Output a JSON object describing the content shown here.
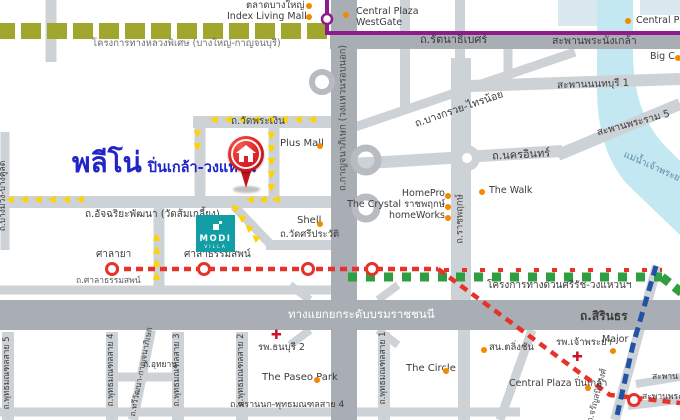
{
  "meta": {
    "width": 680,
    "height": 420,
    "description_visible": false
  },
  "brand": {
    "name": "พลีโน่",
    "subtitle": "ปิ่นเกล้า-วงแหวน"
  },
  "modi": {
    "line1": "MODI",
    "line2": "VILLA"
  },
  "icons": {
    "route-arrow": "◀",
    "hospital-cross": "✚",
    "poi-dot": "orange-circle",
    "station": "red-ring-circle"
  },
  "colors": {
    "brand_blue": "#2125c8",
    "pin_red": "#dc2026",
    "modi_teal": "#119fa5",
    "purple_line": "#8e1b8b",
    "red_line": "#e8312a",
    "green_line": "#2f9e41",
    "blue_line": "#2053a4",
    "route_arrow_yellow": "#ffd200",
    "motorway_olive": "#a1a72c",
    "poi_orange": "#f28a00",
    "river_blue": "#c3e8f2",
    "road_minor": "#cdd2d6",
    "road_major": "#a9aeb4"
  },
  "map": {
    "labels": [
      {
        "id": "talat-bang-yai-label",
        "text": "ตลาดบางใหญ่",
        "x": 246,
        "y": 1,
        "size": 9.5
      },
      {
        "id": "index-living-mall-label",
        "text": "Index Living Mall",
        "x": 227,
        "y": 12,
        "size": 9.5
      },
      {
        "id": "motorway-project-label",
        "text": "โครงการทางหลวงพิเศษ (บางใหญ่-กาญจนบุรี)",
        "x": 92,
        "y": 39,
        "size": 9.5,
        "color": "#6e6e6e"
      },
      {
        "id": "central-westgate-label",
        "text": "Central Plaza WestGate",
        "x": 356,
        "y": 7,
        "size": 9.5,
        "w": 66
      },
      {
        "id": "central-plaza-tr-label",
        "text": "Central Plaz",
        "x": 636,
        "y": 16,
        "size": 9.5
      },
      {
        "id": "rattanathibet-road-label",
        "text": "ถ.รัตนาธิเบศร์",
        "x": 420,
        "y": 34,
        "size": 11
      },
      {
        "id": "phranangklao-bridge-label",
        "text": "สะพานพระนั่งเกล้า",
        "x": 552,
        "y": 36,
        "size": 10.5
      },
      {
        "id": "big-c-label",
        "text": "Big C",
        "x": 650,
        "y": 52,
        "size": 9.5
      },
      {
        "id": "nonthaburi1-bridge-label",
        "text": "สะพานนนทบุรี 1",
        "x": 557,
        "y": 79,
        "size": 10,
        "rot": -2
      },
      {
        "id": "bang-kruai-sai-noi-road-label",
        "text": "ถ.บางกรวย-ไทรน้อย",
        "x": 413,
        "y": 104,
        "size": 10.5,
        "rot": -19
      },
      {
        "id": "rama5-bridge-label",
        "text": "สะพานพระราม 5",
        "x": 596,
        "y": 118,
        "size": 10,
        "rot": -15
      },
      {
        "id": "chao-phraya-river-label",
        "text": "แม่น้ำเจ้าพระยา",
        "x": 621,
        "y": 163,
        "size": 9.5,
        "rot": 24,
        "color": "#5b8ca6"
      },
      {
        "id": "nakhon-in-road-label",
        "text": "ถ.นครอินทร์",
        "x": 492,
        "y": 149,
        "size": 11,
        "rot": -3
      },
      {
        "id": "kanchanaphisek-road-label",
        "text": "ถ.กาญจนาภิเษก (วงแหวนรอบนอก)",
        "x": 344,
        "y": 118,
        "size": 9.5,
        "v": true,
        "color": "#4a4a4a"
      },
      {
        "id": "ratchaphruek-road-label",
        "text": "ถ.ราชพฤกษ์",
        "x": 461,
        "y": 219,
        "size": 9.5,
        "v": true,
        "color": "#4a4a4a"
      },
      {
        "id": "wat-phra-ngoen-road-label",
        "text": "ถ.วัดพระเงิน",
        "x": 231,
        "y": 116,
        "size": 10
      },
      {
        "id": "plus-mall-label",
        "text": "Plus Mall",
        "x": 280,
        "y": 138,
        "size": 10
      },
      {
        "id": "atchariya-road-label",
        "text": "ถ.อัจฉริยะพัฒนา (วัดส้มเกลี้ยง)",
        "x": 85,
        "y": 209,
        "size": 10
      },
      {
        "id": "shell-label",
        "text": "Shell",
        "x": 297,
        "y": 215,
        "size": 10
      },
      {
        "id": "wat-si-prawat-road-label",
        "text": "ถ.วัดศรีประวัติ",
        "x": 280,
        "y": 230,
        "size": 9.5
      },
      {
        "id": "homepro-label",
        "text": "HomePro",
        "x": 445,
        "y": 189,
        "size": 9.5,
        "align": "right"
      },
      {
        "id": "the-crystal-label",
        "text": "The Crystal ราชพฤกษ์",
        "x": 445,
        "y": 200,
        "size": 9.5,
        "align": "right"
      },
      {
        "id": "homeworks-label",
        "text": "homeWorks",
        "x": 445,
        "y": 211,
        "size": 9.5,
        "align": "right"
      },
      {
        "id": "the-walk-label",
        "text": "The Walk",
        "x": 489,
        "y": 186,
        "size": 9.5
      },
      {
        "id": "salaya-station-label",
        "text": "ศาลายา",
        "x": 96,
        "y": 249,
        "size": 10
      },
      {
        "id": "sala-thammasop-station-label",
        "text": "ศาลาธรรมสพน์",
        "x": 184,
        "y": 249,
        "size": 10
      },
      {
        "id": "sala-thammasop-road-label",
        "text": "ถ.ศาลาธรรมสพน์",
        "x": 76,
        "y": 277,
        "size": 8.5,
        "color": "#5a5a5a"
      },
      {
        "id": "si-rat-expressway-label",
        "text": "โครงการทางด่วนศรีรัช-วงแหวนฯ",
        "x": 487,
        "y": 280,
        "size": 10
      },
      {
        "id": "borom-interchange-label",
        "text": "ทางแยกยกระดับบรมราชชนนี",
        "x": 288,
        "y": 308,
        "size": 11.5,
        "color": "#ffffff"
      },
      {
        "id": "sirindhorn-road-label",
        "text": "ถ.สิรินธร",
        "x": 580,
        "y": 310,
        "size": 12,
        "bold": true
      },
      {
        "id": "charan-road-label",
        "text": "ถ.จรัญสนิทวงศ์",
        "x": 598,
        "y": 396,
        "size": 8.5,
        "rot": -75,
        "anchor": "center",
        "color": "#4a4a4a"
      },
      {
        "id": "talingchan-police-label",
        "text": "สน.ตลิ่งชัน",
        "x": 489,
        "y": 343,
        "size": 9.5
      },
      {
        "id": "chaophraya-hospital-label",
        "text": "รพ.เจ้าพระยา",
        "x": 556,
        "y": 338,
        "size": 9.5
      },
      {
        "id": "major-label",
        "text": "Major",
        "x": 602,
        "y": 335,
        "size": 9.5
      },
      {
        "id": "central-pinklao-label",
        "text": "Central Plaza ปิ่นเกล้า",
        "x": 509,
        "y": 379,
        "size": 9.5
      },
      {
        "id": "bridge-label-1",
        "text": "สะพาน",
        "x": 652,
        "y": 373,
        "size": 8.5
      },
      {
        "id": "bridge-label-2",
        "text": "สะพานพระ",
        "x": 642,
        "y": 393,
        "size": 8.5
      },
      {
        "id": "the-circle-label",
        "text": "The Circle",
        "x": 406,
        "y": 363,
        "size": 10
      },
      {
        "id": "paseo-park-label",
        "text": "The Paseo Park",
        "x": 262,
        "y": 372,
        "size": 10
      },
      {
        "id": "thonburi2-hospital-label",
        "text": "รพ.ธนบุรี 2",
        "x": 258,
        "y": 343,
        "size": 9.5
      },
      {
        "id": "thonburi2-cross-icon",
        "text": "✚",
        "x": 271,
        "y": 329,
        "size": 13,
        "cls": "cross"
      },
      {
        "id": "chaophraya-cross-icon",
        "text": "✚",
        "x": 572,
        "y": 351,
        "size": 13,
        "cls": "cross"
      },
      {
        "id": "sai5-road-label",
        "text": "ถ.พุทธมณฑลสาย 5",
        "x": 8,
        "y": 373,
        "size": 8.5,
        "v": true
      },
      {
        "id": "sai4-road-label",
        "text": "ถ.พุทธมณฑลสาย 4",
        "x": 112,
        "y": 370,
        "size": 8.5,
        "v": true
      },
      {
        "id": "thawi-watthana-road-label",
        "text": "ถ.ทวีวัฒนา-กาญจนาภิเษก",
        "x": 142,
        "y": 372,
        "size": 8,
        "rot": -79,
        "anchor": "center"
      },
      {
        "id": "sai3-road-label",
        "text": "ถ.พุทธมณฑลสาย 3",
        "x": 178,
        "y": 370,
        "size": 8.5,
        "v": true
      },
      {
        "id": "uthayan-road-label",
        "text": "ถ.อุทยาน",
        "x": 143,
        "y": 361,
        "size": 8.5
      },
      {
        "id": "sai2-road-label",
        "text": "ถ.พุทธมณฑลสาย 2",
        "x": 242,
        "y": 370,
        "size": 8.5,
        "v": true
      },
      {
        "id": "sai1-road-label",
        "text": "ถ.พุทธมณฑลสาย 1",
        "x": 384,
        "y": 368,
        "size": 8.5,
        "v": true
      },
      {
        "id": "phran-nok-road-label",
        "text": "ถ.พรานนก-พุทธมณฑลสาย 4",
        "x": 230,
        "y": 400,
        "size": 9
      },
      {
        "id": "bang-muang-road-label",
        "text": "ถ.บางม่วง-บางคูลัด",
        "x": 4,
        "y": 196,
        "size": 8.5,
        "v": true
      }
    ],
    "dots": [
      [
        309,
        6
      ],
      [
        309,
        17
      ],
      [
        346,
        15
      ],
      [
        628,
        21
      ],
      [
        678,
        58
      ],
      [
        320,
        146
      ],
      [
        320,
        224
      ],
      [
        448,
        196
      ],
      [
        448,
        207
      ],
      [
        448,
        218
      ],
      [
        482,
        192
      ],
      [
        484,
        350
      ],
      [
        613,
        351
      ],
      [
        588,
        388
      ],
      [
        317,
        380
      ],
      [
        446,
        371
      ]
    ],
    "arrow_routes": [
      {
        "x": 210,
        "y": 115,
        "dx": 14,
        "dy": 0,
        "n": 8,
        "rot": 0
      },
      {
        "x": 268,
        "y": 131,
        "dx": 0,
        "dy": 13,
        "n": 5,
        "rot": -90
      },
      {
        "x": 194,
        "y": 129,
        "dx": 0,
        "dy": 13,
        "n": 2,
        "rot": -90
      },
      {
        "x": 6,
        "y": 195,
        "dx": 14,
        "dy": 0,
        "n": 6,
        "rot": 0
      },
      {
        "x": 246,
        "y": 195,
        "dx": 13,
        "dy": 0,
        "n": 3,
        "rot": 0
      },
      {
        "x": 152,
        "y": 271,
        "dx": 0,
        "dy": -13,
        "n": 4,
        "rot": 90
      },
      {
        "x": 251,
        "y": 233,
        "dx": -7,
        "dy": -10,
        "n": 4,
        "rot": 40
      }
    ],
    "stations_red": [
      [
        112,
        269
      ],
      [
        204,
        269
      ],
      [
        308,
        269
      ],
      [
        372,
        269
      ],
      [
        634,
        400
      ]
    ],
    "station_purple": [
      327,
      19
    ]
  }
}
